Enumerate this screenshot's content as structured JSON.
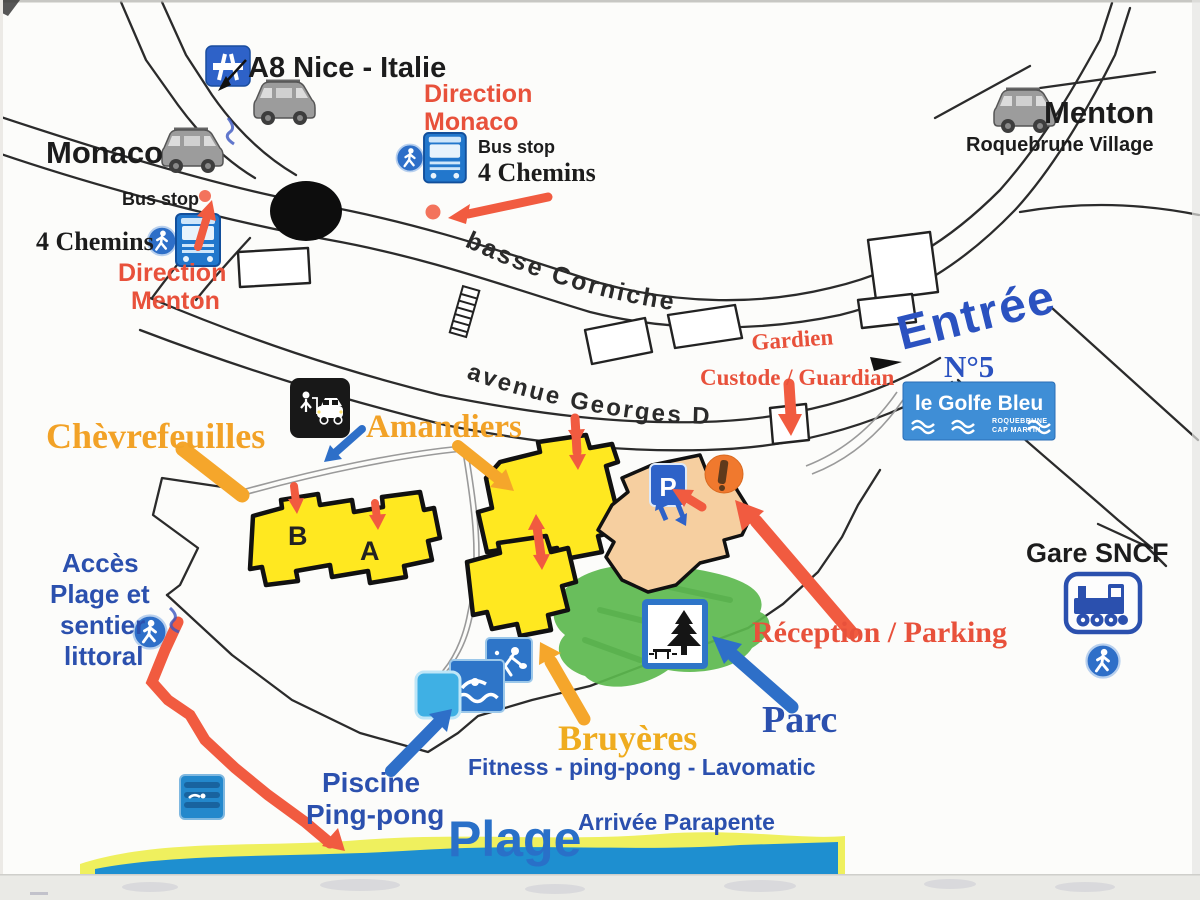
{
  "map": {
    "top_left": {
      "a8": "A8 Nice - Italie",
      "monaco": "Monaco",
      "bus_stop": "Bus stop",
      "four_chemins": "4 Chemins",
      "direction_line1": "Direction",
      "direction_line2": "Menton"
    },
    "top_center": {
      "direction_line1": "Direction",
      "direction_line2": "Monaco",
      "bus_stop": "Bus stop",
      "four_chemins": "4 Chemins"
    },
    "top_right": {
      "menton": "Menton",
      "village": "Roquebrune Village"
    },
    "roads": {
      "basse_corniche": "basse Corniche",
      "avenue_georges_drin": "avenue Georges Drin"
    },
    "entrance": {
      "gardien": "Gardien",
      "custode": "Custode / Guardian",
      "entree": "Entrée",
      "number": "N°5"
    },
    "sign": {
      "name": "le Golfe Bleu",
      "sub1": "ROQUEBRUNE",
      "sub2": "CAP MARTIN"
    },
    "residences": {
      "chevrefeuilles": "Chèvrefeuilles",
      "amandiers": "Amandiers",
      "bruyeres": "Bruyères",
      "block_b": "B",
      "block_a": "A"
    },
    "facilities": {
      "reception_parking": "Réception / Parking",
      "parc": "Parc",
      "fitness": "Fitness - ping-pong - Lavomatic",
      "piscine_line1": "Piscine",
      "piscine_line2": "Ping-pong",
      "parking_letter": "P"
    },
    "coast": {
      "acces_line1": "Accès",
      "acces_line2": "Plage et",
      "acces_line3": "sentier",
      "acces_line4": "littoral",
      "plage": "Plage",
      "parapente": "Arrivée Parapente"
    },
    "station": {
      "gare": "Gare SNCF"
    },
    "colors": {
      "building_yellow": "#FFE820",
      "reception_peach": "#F6CFA0",
      "park_green": "#5CB84E",
      "sea_blue": "#1E8FD0",
      "sand_yellow": "#EFF05E",
      "arrow_red": "#F15B40",
      "arrow_orange": "#F5A62B",
      "label_blue": "#2B50AE",
      "label_red": "#E8513B",
      "label_orange": "#F2A227",
      "sign_blue": "#2E6FC8"
    }
  }
}
